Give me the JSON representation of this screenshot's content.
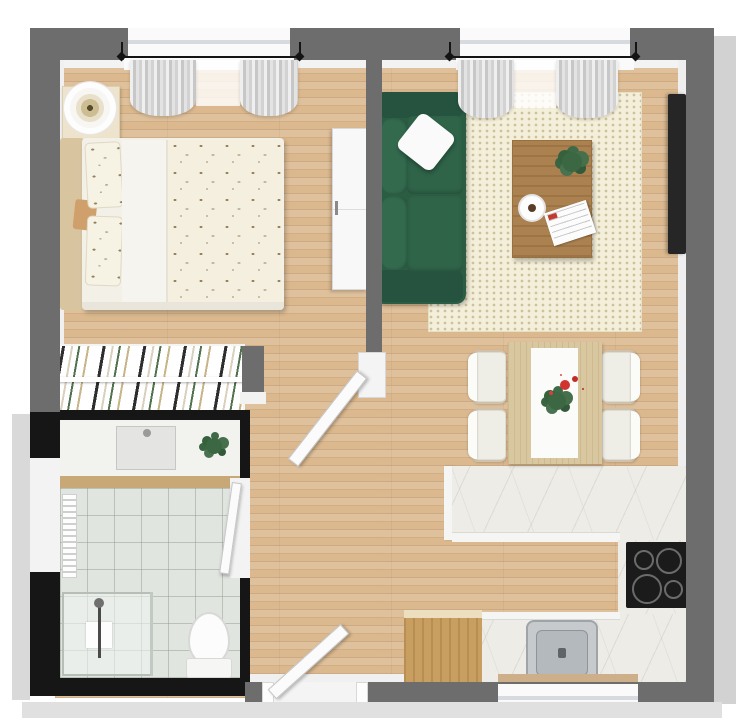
{
  "meta": {
    "title": "3D floor plan — one-bedroom apartment, top-down render",
    "render_style": "photorealistic 3D top view, no text labels"
  },
  "palette": {
    "wall_gray": "#6d6d6d",
    "wall_black": "#161616",
    "outer_gray": "#d2d2d2",
    "floor_wood": "#dbb88e",
    "marble": "#edece7",
    "counter_face": "#f5f5f3",
    "sofa_green": "#2b5d43",
    "rug_cream": "#f4efda",
    "tile_gray": "#e1e5df",
    "cabinet_wood": "#c89f60",
    "dining_wood": "#d9c7a0",
    "coffee_wood": "#ab8150",
    "sill_wood": "#cdb089",
    "threshold_tan": "#c9a877",
    "headboard_tan": "#d8c5a0",
    "bed_cream": "#f5efdf",
    "tv_black": "#262626",
    "cooktop_black": "#1b1b1b",
    "steel_gray": "#c6cacd",
    "plant_green": "#3c6743",
    "flower_red": "#d23430",
    "curtain_gray": "#d6d6d6",
    "measure_black": "#141414",
    "door_white": "#fbfbfb"
  },
  "rooms": {
    "bedroom": {
      "name": "Bedroom",
      "items": [
        "double bed with bird-print duvet",
        "two bird-print pillows",
        "tan headboard",
        "nightstand",
        "round table lamp",
        "white dresser",
        "window with gray curtains",
        "open white door"
      ]
    },
    "living_room": {
      "name": "Living room",
      "items": [
        "green two-seat sofa",
        "white throw pillow",
        "cream dotted area rug",
        "wooden coffee table",
        "potted plant",
        "coffee cup",
        "newspaper",
        "wall-mounted TV",
        "window with gray curtains"
      ]
    },
    "dining_area": {
      "name": "Dining area",
      "items": [
        "light wood dining table",
        "white table runner",
        "red flower centerpiece",
        "four white chairs"
      ]
    },
    "kitchen": {
      "name": "Kitchen",
      "items": [
        "L-shaped marble countertop",
        "black 4-burner cooktop",
        "stainless steel sink",
        "window above sink",
        "wooden sideboard"
      ]
    },
    "bathroom": {
      "name": "Bathroom",
      "items": [
        "vanity with basin",
        "potted plant",
        "towel radiator",
        "walk-in shower with glass screen",
        "toilet",
        "frosted window",
        "white door",
        "wooden threshold"
      ]
    },
    "wardrobe": {
      "name": "Wardrobe nook",
      "items": [
        "open clothes rail",
        "hanging clothes in white, black, green and tan"
      ]
    },
    "hallway": {
      "name": "Hallway",
      "items": [
        "open entrance door"
      ]
    }
  },
  "annotations": {
    "bedroom_window_dimension": "dimension line across bedroom window",
    "living_window_dimension": "dimension line across living room window"
  }
}
